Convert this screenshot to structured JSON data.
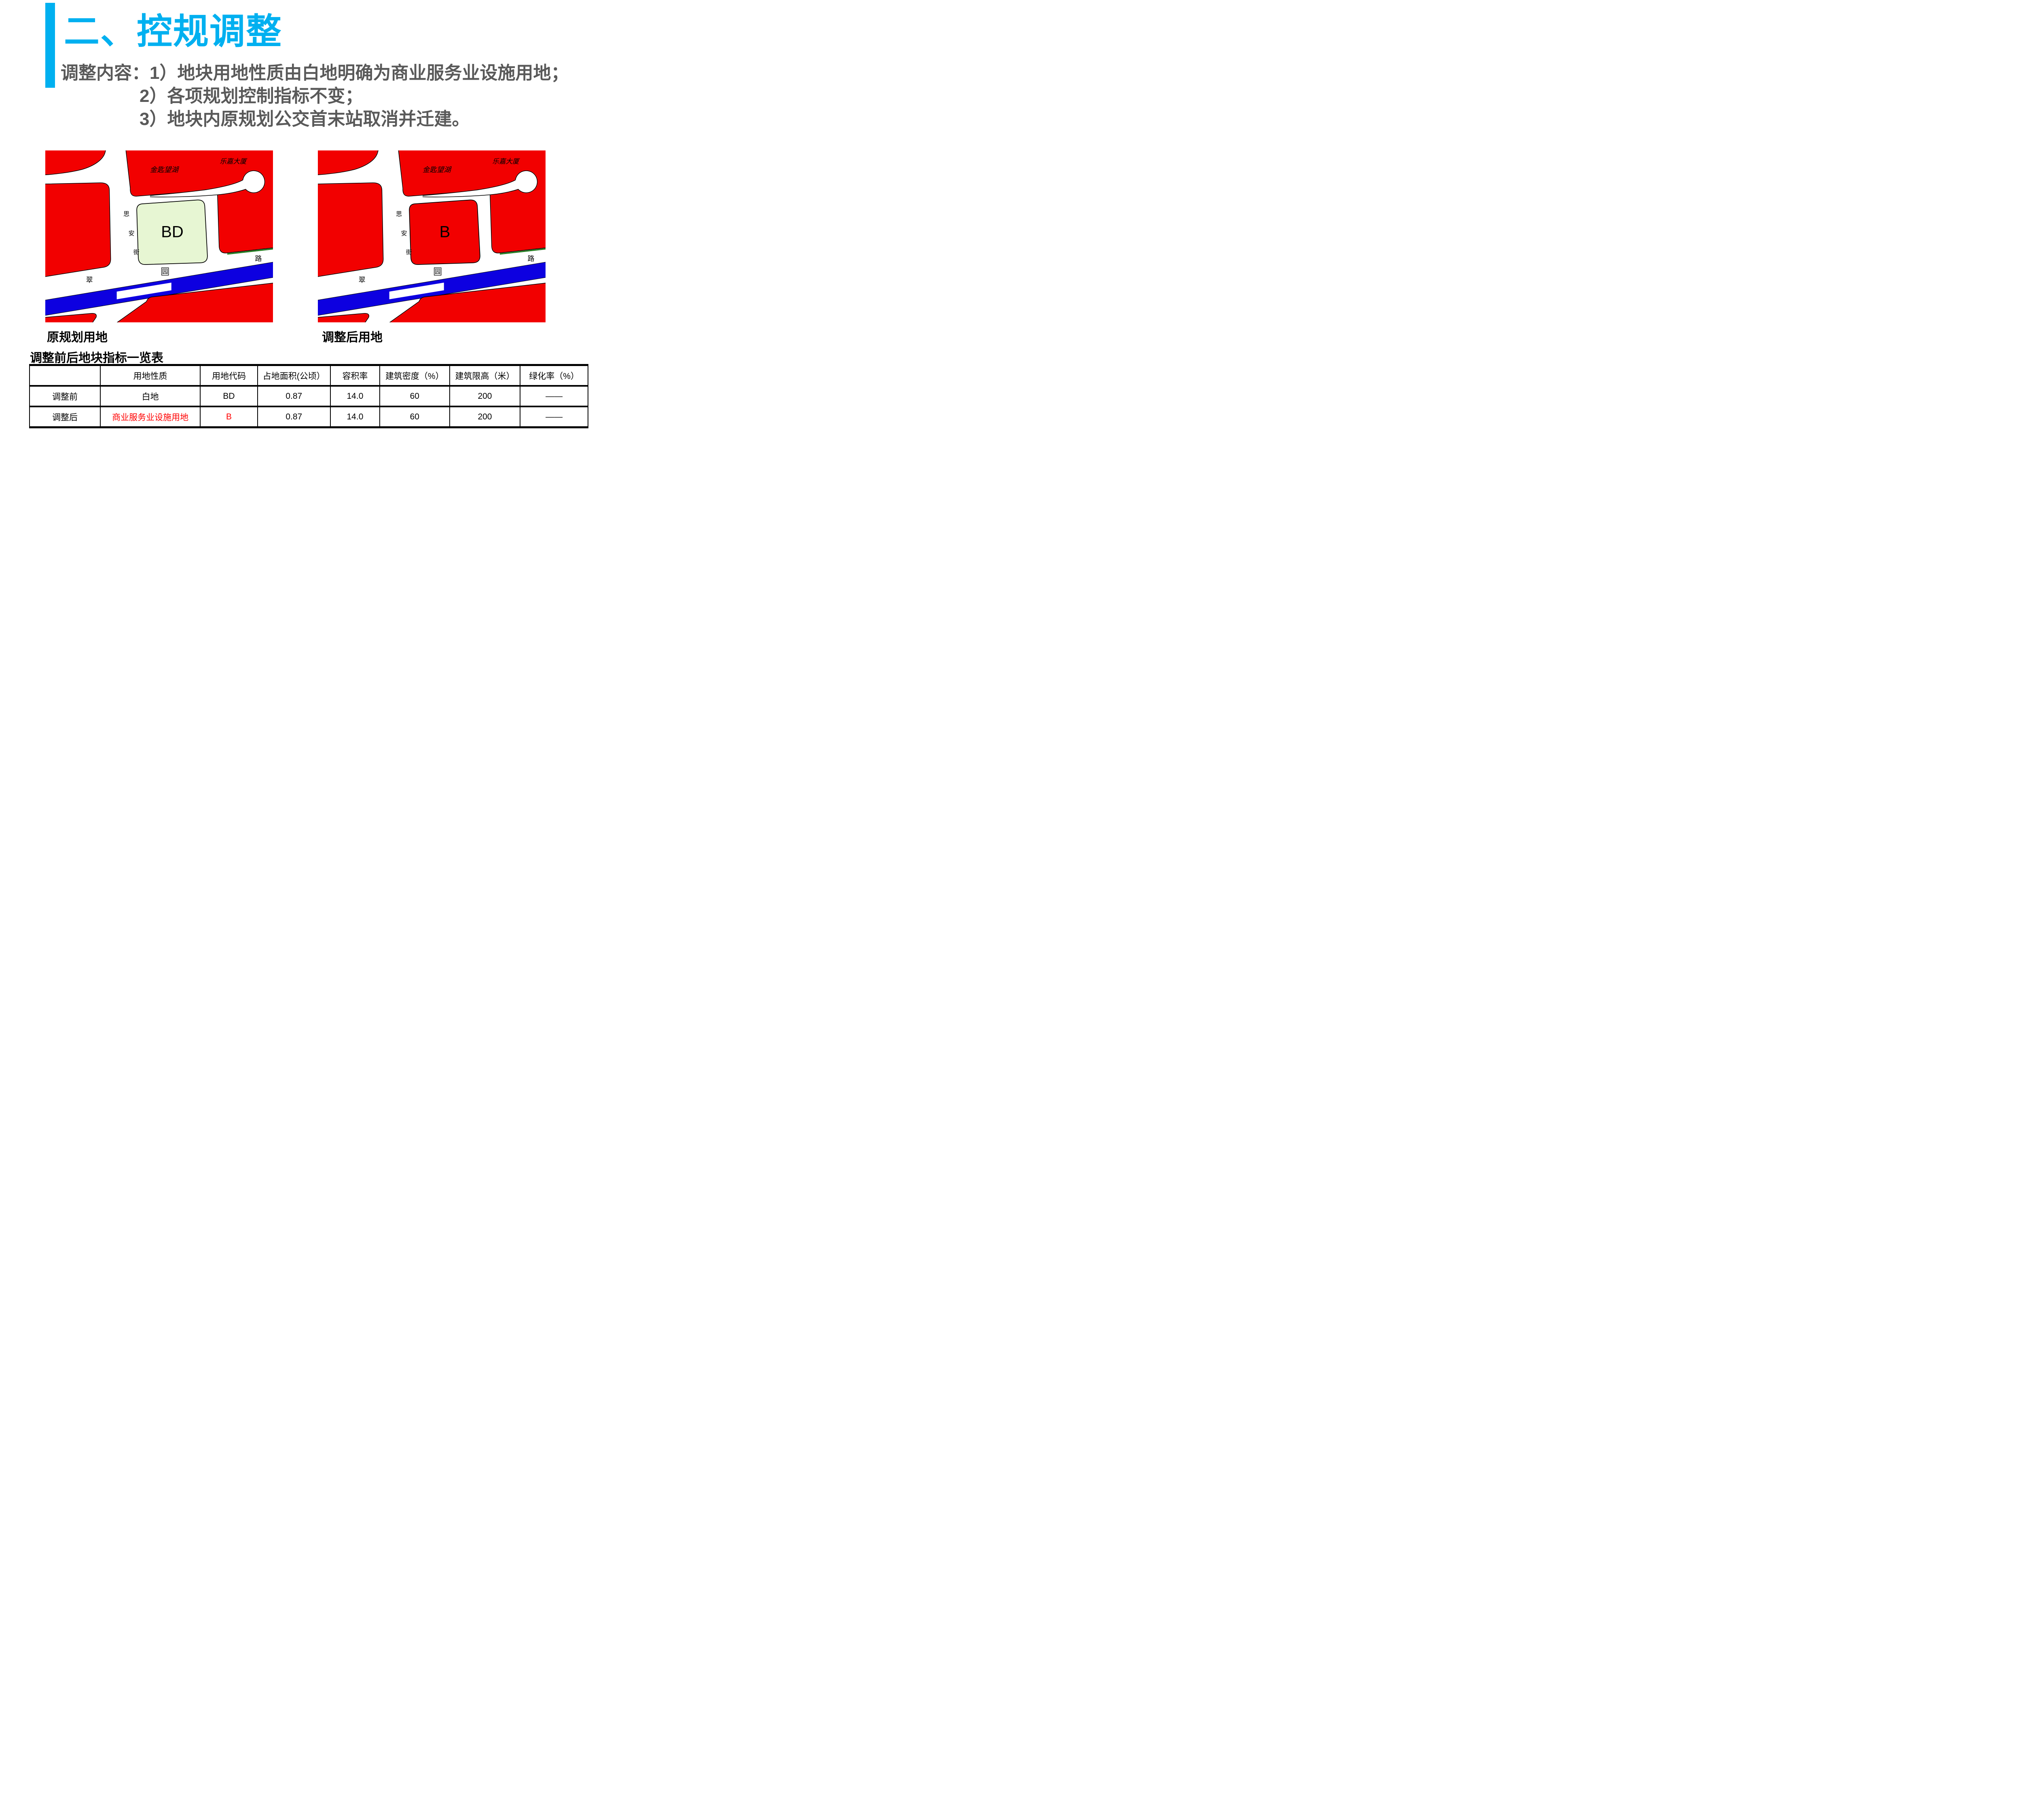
{
  "slide": {
    "title": "二、控规调整",
    "title_color": "#00B0F0",
    "body_color": "#595959",
    "body_lines": [
      "调整内容：1）地块用地性质由白地明确为商业服务业设施用地；",
      "2）各项规划控制指标不变；",
      "3）地块内原规划公交首末站取消并迁建。"
    ]
  },
  "maps": {
    "left": {
      "caption": "原规划用地",
      "parcel_label": "BD",
      "parcel_fill": "#E7F6D3"
    },
    "right": {
      "caption": "调整后用地",
      "parcel_label": "B",
      "parcel_fill": "#F20000"
    },
    "shared_labels": {
      "top_block": "金匙望湖",
      "topright_block": "乐嘉大厦",
      "street_char1": "思",
      "street_char2": "安",
      "street_char3": "街",
      "road_char_left": "翠",
      "road_char_mid": "园",
      "road_char_right": "路"
    },
    "colors": {
      "block_red": "#F20000",
      "road_blue": "#0D00E0",
      "greenbelt": "#267F22",
      "outline": "#000000"
    }
  },
  "table": {
    "title": "调整前后地块指标一览表",
    "headers": [
      "",
      "用地性质",
      "用地代码",
      "占地面积(公顷）",
      "容积率",
      "建筑密度（%）",
      "建筑限高（米）",
      "绿化率（%）"
    ],
    "rows": [
      {
        "label": "调整前",
        "values": [
          "白地",
          "BD",
          "0.87",
          "14.0",
          "60",
          "200",
          "——"
        ]
      },
      {
        "label": "调整后",
        "values": [
          "商业服务业设施用地",
          "B",
          "0.87",
          "14.0",
          "60",
          "200",
          "——"
        ]
      }
    ],
    "changed_color": "#FF0000"
  }
}
